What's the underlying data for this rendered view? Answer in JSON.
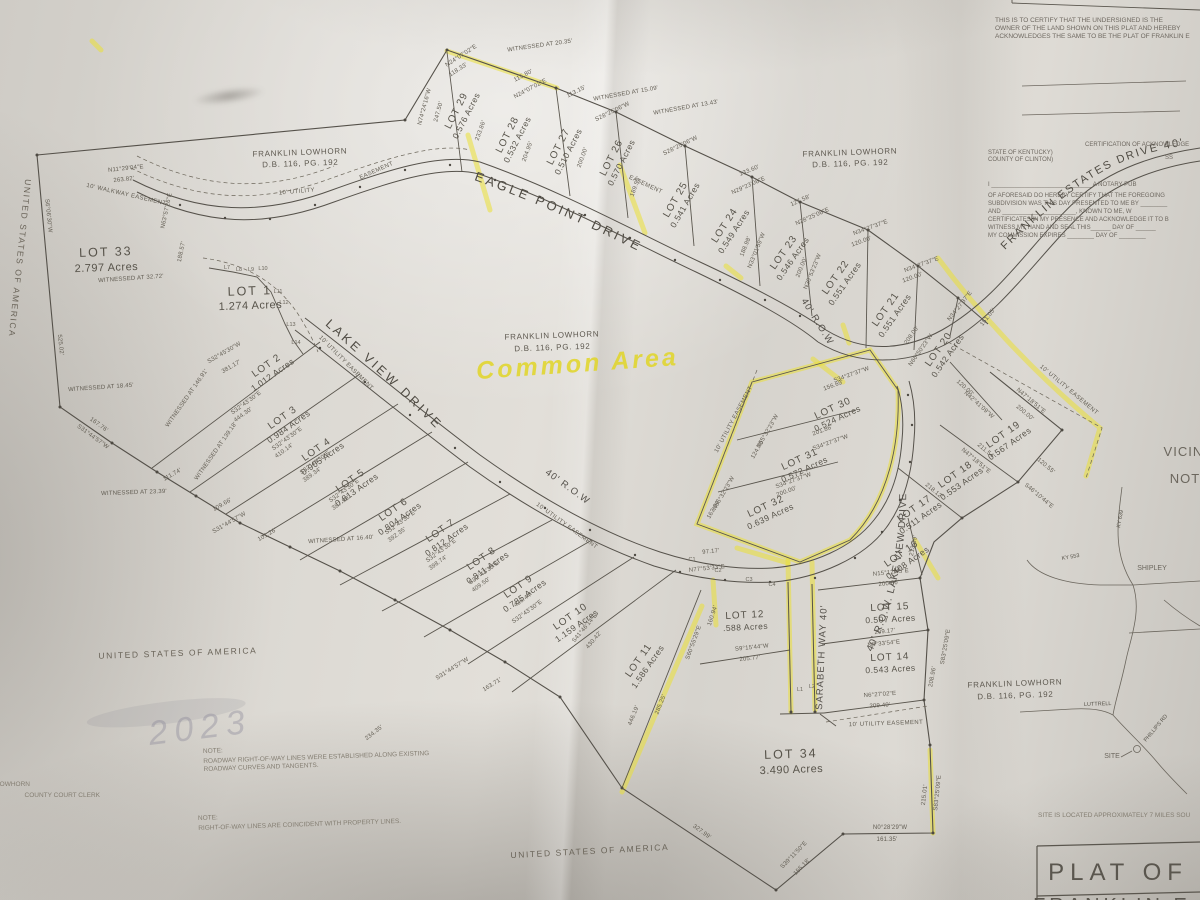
{
  "doc": {
    "certify_lines": [
      "THIS IS TO CERTIFY THAT THE UNDERSIGNED IS THE",
      "OWNER OF THE LAND SHOWN ON THIS PLAT AND HEREBY",
      "ACKNOWLEDGES THE SAME TO BE THE PLAT OF FRANKLIN E"
    ],
    "ack": {
      "heading": "CERTIFICATION OF ACKNOWLEDGE",
      "state": "STATE OF KENTUCKY)",
      "county": "COUNTY OF CLINTON)",
      "ss": "SS",
      "lines": [
        "I ______________________________ A NOTARY PUB",
        "OF AFORESAID DO HEREBY CERTIFY THAT THE FOREGOING",
        "SUBDIVISION WAS THIS DAY PRESENTED TO ME BY ________",
        "AND ______________________, KNOWN TO ME, W",
        "CERTIFICATES IN MY PRESENCE AND ACKNOWLEDGE IT TO B",
        "WITNESS MY HAND AND SEAL THIS______ DAY OF ______",
        "MY COMMISSION EXPIRES ________ DAY OF ________"
      ]
    },
    "notes": {
      "n1t": "NOTE:",
      "n1a": "ROADWAY RIGHT-OF-WAY LINES WERE ESTABLISHED ALONG EXISTING",
      "n1b": "ROADWAY CURVES AND TANGENTS.",
      "n2t": "NOTE:",
      "n2a": "RIGHT-OF-WAY LINES ARE COINCIDENT WITH PROPERTY LINES."
    },
    "site_note": "SITE IS LOCATED APPROXIMATELY 7 MILES SOU",
    "title_block": {
      "l1": "PLAT OF",
      "l2": "FRANKLIN E"
    },
    "clerk": {
      "l1": "LOWHORN",
      "l2": "COUNTY COURT CLERK"
    },
    "stamp": "2023"
  },
  "owners": {
    "name": "FRANKLIN LOWHORN",
    "deed": "D.B. 116, PG. 192",
    "usa": "UNITED STATES OF AMERICA"
  },
  "roads": {
    "eagle": "EAGLE POINT DRIVE",
    "lake": "LAKE VIEW DRIVE",
    "lake_row": "40' R.O.W.  LAKE VIEW DRIVE",
    "franklin": "FRANKLIN ESTATES DRIVE 40'",
    "sarabeth": "SARABETH WAY 40'",
    "row": "40' R.O.W"
  },
  "ease": [
    "10' UTILITY",
    "EASEMENT",
    "EASEMENT",
    "10' UTILITY EASEMENT",
    "10' UTILITY EASEMENT",
    "10' UTILITY EASEMENT",
    "10' UTILITY EASEMENT",
    "10' UTILITY EASEMENT",
    "10' WALKWAY EASEMENT"
  ],
  "hl": {
    "note": "Common Area"
  },
  "lots": [
    {
      "n": "LOT 1",
      "a": "1.274  Acres"
    },
    {
      "n": "LOT 2",
      "a": "1.012  Acres"
    },
    {
      "n": "LOT 3",
      "a": "0.984  Acres"
    },
    {
      "n": "LOT 4",
      "a": "0.905  Acres"
    },
    {
      "n": "LOT 5",
      "a": "0.813  Acres"
    },
    {
      "n": "LOT 6",
      "a": "0.804  Acres"
    },
    {
      "n": "LOT 7",
      "a": "0.812  Acres"
    },
    {
      "n": "LOT 8",
      "a": "0.811  Acres"
    },
    {
      "n": "LOT 9",
      "a": "0.785  Acres"
    },
    {
      "n": "LOT 10",
      "a": "1.159  Acres"
    },
    {
      "n": "LOT 11",
      "a": "1.586  Acres"
    },
    {
      "n": "LOT 12",
      "a": ".588  Acres"
    },
    {
      "n": "LOT 14",
      "a": "0.543  Acres"
    },
    {
      "n": "LOT 15",
      "a": "0.507  Acres"
    },
    {
      "n": "LOT 16",
      "a": "0.408  Acres"
    },
    {
      "n": "LOT 17",
      "a": "0.511  Acres"
    },
    {
      "n": "LOT 18",
      "a": "0.553  Acres"
    },
    {
      "n": "LOT 19",
      "a": "0.567  Acres"
    },
    {
      "n": "LOT 20",
      "a": "0.542  Acres"
    },
    {
      "n": "LOT 21",
      "a": "0.551  Acres"
    },
    {
      "n": "LOT 22",
      "a": "0.551  Acres"
    },
    {
      "n": "LOT 23",
      "a": "0.546  Acres"
    },
    {
      "n": "LOT 24",
      "a": "0.549  Acres"
    },
    {
      "n": "LOT 25",
      "a": "0.541  Acres"
    },
    {
      "n": "LOT 26",
      "a": "0.570  Acres"
    },
    {
      "n": "LOT 27",
      "a": "0.510  Acres"
    },
    {
      "n": "LOT 28",
      "a": "0.532  Acres"
    },
    {
      "n": "LOT 29",
      "a": "0.576  Acres"
    },
    {
      "n": "LOT 30",
      "a": "0.524  Acres"
    },
    {
      "n": "LOT 31",
      "a": "0.572  Acres"
    },
    {
      "n": "LOT 32",
      "a": "0.639  Acres"
    },
    {
      "n": "LOT 33",
      "a": "2.797  Acres"
    },
    {
      "n": "LOT 34",
      "a": "3.490  Acres"
    }
  ],
  "b": [
    "WITNESSED AT 20.35'",
    "N24°07'02\"E",
    "118.33'",
    "115.80'",
    "N24°07'02\"E",
    "113.15'",
    "WITNESSED AT 15.09'",
    "WITNESSED AT 13.43'",
    "S28°25'06\"W",
    "S28°25'06\"W",
    "133.60'",
    "N29°23'06\"E",
    "127.58'",
    "N28°25'06\"E",
    "N34°27'37\"E",
    "120.00'",
    "N34°27'37\"E",
    "120.00'",
    "N34°27'37\"E",
    "151.05'",
    "N74°24'16\"W",
    "247.50'",
    "233.86'",
    "204.95'",
    "200.00'",
    "189.55'",
    "188.98'",
    "N33°01'59\"W",
    "200.00'",
    "N30°53'23\"W",
    "N11°29'04\"E",
    "263.82'",
    "S6°06'30\"W",
    "525.02'",
    "WITNESSED AT 32.72'",
    "N63°57'26\"E",
    "188.57'",
    "WITNESSED AT 18.45'",
    "167.76'",
    "S31°44'57\"W",
    "WITNESSED AT 23.39'",
    "111.74'",
    "109.66'",
    "S31°44'57\"W",
    "101.26'",
    "S32°45'30\"W",
    "381.17'",
    "WITNESSED AT 146.91'",
    "S32°43'30\"E",
    "444.30'",
    "WITNESSED AT 139.18'",
    "S32°43'30\"E",
    "410.14'",
    "S32°43'30\"E",
    "389.34'",
    "S32°43'30\"E",
    "387.90'",
    "WITNESSED AT 16.40'",
    "S32°43'30\"E",
    "392.35'",
    "S32°43'30\"E",
    "398.74'",
    "S32°43'30\"E",
    "409.50'",
    "436.44'",
    "S32°43'30\"E",
    "S41°46'14\"E",
    "430.42'",
    "S31°44'57\"W",
    "163.71'",
    "234.35'",
    "446.19'",
    "285.25'",
    "S60°55'29\"E",
    "160.94'",
    "S9°15'44\"W",
    "205.77'",
    "327.99'",
    "S39°11'50\"E",
    "155.18'",
    "N0°28'29\"W",
    "161.35'",
    "215.01'",
    "S83°25'09\"E",
    "N15°12'45\"E",
    "200.00'",
    "209.17'",
    "N8°33'54\"E",
    "N6°27'02\"E",
    "209.40'",
    "S83°25'09\"E",
    "208.96'",
    "213.39'",
    "97.17'",
    "N77°53'33\"E",
    "N55°32'23\"W",
    "124.70'",
    "N55°32'23\"W",
    "163.94'",
    "S34°27'37\"W",
    "156.69'",
    "201.86'",
    "S34°27'37\"W",
    "S34°27'37\"W",
    "200.00'",
    "120.00'",
    "N42°41'09\"W",
    "N47°18'51\"E",
    "200.00'",
    "211.54'",
    "N47°18'51\"E",
    "120.55'",
    "S46°10'44\"E",
    "218.12'",
    "208.00'",
    "N66°50'23\"W"
  ],
  "t": [
    "L7",
    "L8",
    "L9",
    "L10",
    "L11",
    "L12",
    "L13",
    "L14",
    "L1",
    "L2",
    "C1",
    "C2",
    "C3",
    "C4"
  ],
  "vic": {
    "t1": "VICINITY",
    "t2": "NOT",
    "shipley": "SHIPLEY",
    "site": "SITE",
    "phillips": "PHILLIPS RD",
    "luttrell": "LUTTRELL",
    "ky1": "KY 639",
    "ky2": "KY 553"
  }
}
